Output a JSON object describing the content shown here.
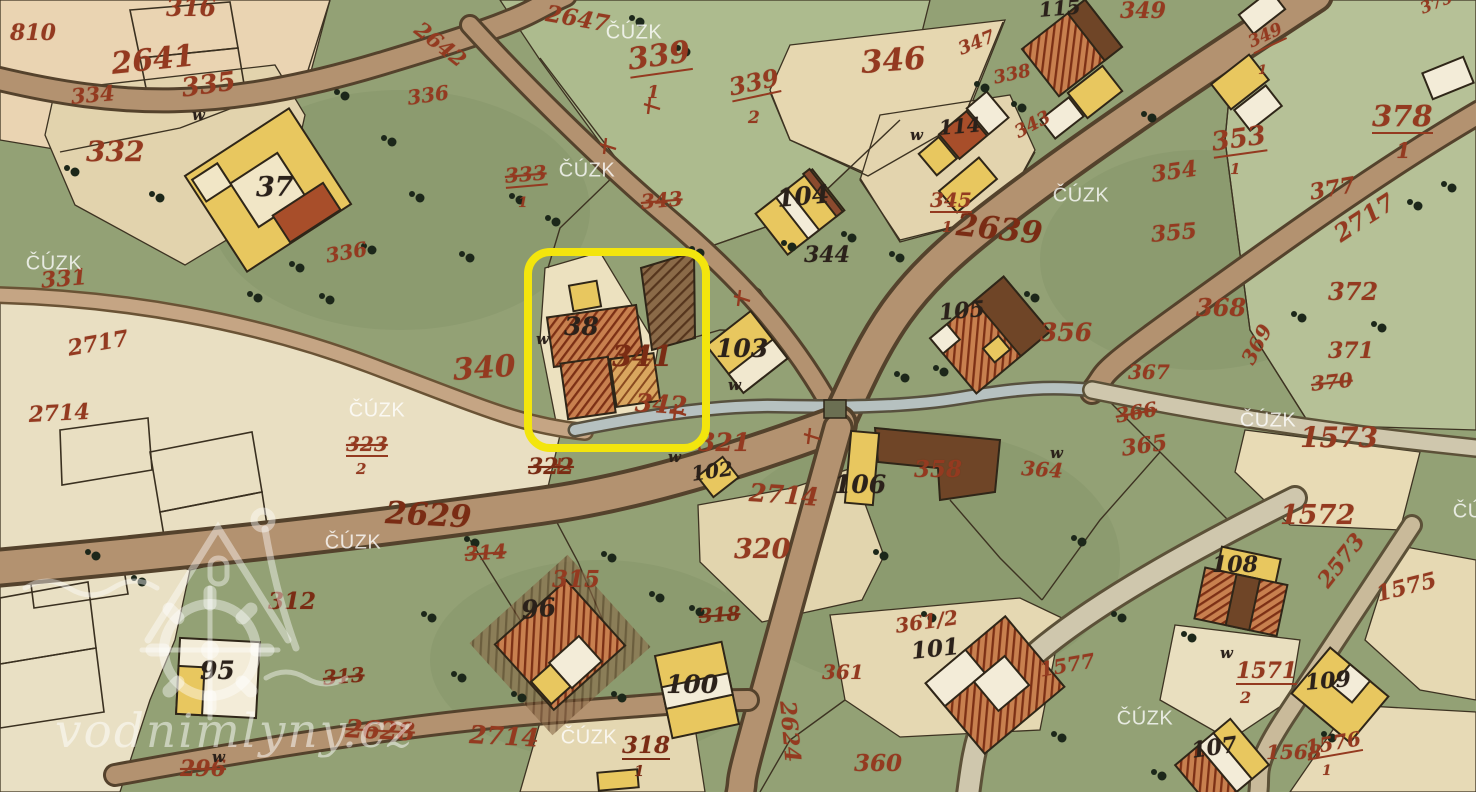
{
  "highlight": {
    "color": "#f3e50d",
    "highlighted_building": "38"
  },
  "watermarks": {
    "cuzk": {
      "text": "ČÚZK",
      "positions": [
        [
          634,
          33
        ],
        [
          587,
          171
        ],
        [
          1081,
          196
        ],
        [
          54,
          264
        ],
        [
          377,
          411
        ],
        [
          1268,
          421
        ],
        [
          353,
          543
        ],
        [
          589,
          738
        ],
        [
          1145,
          719
        ],
        [
          1481,
          512
        ]
      ]
    },
    "site": {
      "text": "vodnimlyny.cz"
    }
  },
  "meadow_marks": {
    "symbol": "w",
    "positions": [
      [
        668,
        450
      ],
      [
        728,
        378
      ],
      [
        910,
        128
      ],
      [
        1220,
        646
      ],
      [
        1050,
        446
      ],
      [
        192,
        108
      ],
      [
        536,
        332
      ],
      [
        212,
        750
      ]
    ]
  },
  "colors": {
    "highlight_yellow": "#f3e50d",
    "parcel_number_red": "#943a20",
    "parcel_number_dark": "#7a2c14",
    "building_number_black": "#2b211a",
    "meadow_green": "#93a175",
    "field_light_green": "#b6c197",
    "field_beige": "#e5d8b4",
    "road_tan": "#b39270",
    "stream_gray": "#b6c1c0",
    "building_yellow": "#e8c75f",
    "building_red": "#c8804f",
    "watermark_white": "rgba(255,255,255,0.78)"
  },
  "map_labels": [
    {
      "t": "810",
      "x": 10,
      "y": 22,
      "s": 22,
      "c": "red"
    },
    {
      "t": "316",
      "x": 166,
      "y": -4,
      "s": 24,
      "c": "red"
    },
    {
      "t": "2641",
      "x": 110,
      "y": 50,
      "s": 30,
      "c": "red",
      "r": -6
    },
    {
      "t": "334",
      "x": 70,
      "y": 86,
      "s": 21,
      "c": "red",
      "r": -5
    },
    {
      "t": "335",
      "x": 180,
      "y": 76,
      "s": 26,
      "c": "red",
      "r": -8
    },
    {
      "t": "332",
      "x": 86,
      "y": 138,
      "s": 28,
      "c": "red"
    },
    {
      "t": "2642",
      "x": 424,
      "y": 18,
      "s": 21,
      "c": "red",
      "r": 38
    },
    {
      "t": "2647",
      "x": 548,
      "y": 2,
      "s": 23,
      "c": "red",
      "r": 10
    },
    {
      "t": "339",
      "x": 626,
      "y": 46,
      "s": 30,
      "c": "red",
      "r": -8,
      "u": 1
    },
    {
      "t": "1",
      "x": 647,
      "y": 84,
      "s": 18,
      "c": "red"
    },
    {
      "t": "339",
      "x": 727,
      "y": 76,
      "s": 24,
      "c": "red",
      "r": -12,
      "u": 1
    },
    {
      "t": "2",
      "x": 748,
      "y": 110,
      "s": 17,
      "c": "red"
    },
    {
      "t": "346",
      "x": 860,
      "y": 48,
      "s": 31,
      "c": "red",
      "r": -4
    },
    {
      "t": "347",
      "x": 956,
      "y": 42,
      "s": 18,
      "c": "red",
      "r": -22
    },
    {
      "t": "338",
      "x": 992,
      "y": 70,
      "s": 18,
      "c": "red",
      "r": -12
    },
    {
      "t": "343",
      "x": 1012,
      "y": 126,
      "s": 18,
      "c": "red",
      "r": -28
    },
    {
      "t": "345",
      "x": 930,
      "y": 190,
      "s": 20,
      "c": "red",
      "u": 1
    },
    {
      "t": "1",
      "x": 942,
      "y": 220,
      "s": 15,
      "c": "red"
    },
    {
      "t": "2639",
      "x": 958,
      "y": 210,
      "s": 31,
      "c": "dark",
      "r": 6
    },
    {
      "t": "349",
      "x": 1120,
      "y": 0,
      "s": 22,
      "c": "red"
    },
    {
      "t": "349",
      "x": 1246,
      "y": 36,
      "s": 17,
      "c": "red",
      "r": -25,
      "u": 1
    },
    {
      "t": "1",
      "x": 1258,
      "y": 64,
      "s": 13,
      "c": "red"
    },
    {
      "t": "375",
      "x": 1418,
      "y": 2,
      "s": 16,
      "c": "red",
      "r": -22
    },
    {
      "t": "378",
      "x": 1372,
      "y": 102,
      "s": 29,
      "c": "red",
      "u": 1
    },
    {
      "t": "1",
      "x": 1396,
      "y": 140,
      "s": 21,
      "c": "red"
    },
    {
      "t": "353",
      "x": 1210,
      "y": 130,
      "s": 26,
      "c": "red",
      "r": -8,
      "u": 1
    },
    {
      "t": "1",
      "x": 1230,
      "y": 162,
      "s": 15,
      "c": "red"
    },
    {
      "t": "354",
      "x": 1150,
      "y": 164,
      "s": 22,
      "c": "red",
      "r": -8
    },
    {
      "t": "377",
      "x": 1308,
      "y": 182,
      "s": 22,
      "c": "red",
      "r": -10
    },
    {
      "t": "355",
      "x": 1150,
      "y": 224,
      "s": 22,
      "c": "red",
      "r": -5
    },
    {
      "t": "2717",
      "x": 1330,
      "y": 226,
      "s": 24,
      "c": "red",
      "r": -33
    },
    {
      "t": "331",
      "x": 40,
      "y": 270,
      "s": 22,
      "c": "red",
      "r": -5
    },
    {
      "t": "336",
      "x": 324,
      "y": 246,
      "s": 20,
      "c": "red",
      "r": -10
    },
    {
      "t": "2717",
      "x": 66,
      "y": 338,
      "s": 22,
      "c": "red",
      "r": -10
    },
    {
      "t": "2714",
      "x": 28,
      "y": 404,
      "s": 22,
      "c": "red",
      "r": -3
    },
    {
      "t": "336",
      "x": 406,
      "y": 88,
      "s": 20,
      "c": "red",
      "r": -8
    },
    {
      "t": "333",
      "x": 504,
      "y": 166,
      "s": 20,
      "c": "red",
      "r": -5,
      "st": 1,
      "u": 1
    },
    {
      "t": "1",
      "x": 518,
      "y": 196,
      "s": 14,
      "c": "red"
    },
    {
      "t": "343",
      "x": 640,
      "y": 192,
      "s": 20,
      "c": "red",
      "r": -5,
      "st": 1
    },
    {
      "t": "340",
      "x": 452,
      "y": 356,
      "s": 30,
      "c": "red",
      "r": -4
    },
    {
      "t": "341",
      "x": 612,
      "y": 342,
      "s": 29,
      "c": "dark"
    },
    {
      "t": "342",
      "x": 636,
      "y": 390,
      "s": 25,
      "c": "red",
      "r": 4
    },
    {
      "t": "323",
      "x": 346,
      "y": 434,
      "s": 20,
      "c": "red",
      "st": 1,
      "u": 1
    },
    {
      "t": "2",
      "x": 356,
      "y": 462,
      "s": 15,
      "c": "red"
    },
    {
      "t": "322",
      "x": 528,
      "y": 456,
      "s": 22,
      "c": "dark",
      "st": 1
    },
    {
      "t": "321",
      "x": 698,
      "y": 430,
      "s": 25,
      "c": "red"
    },
    {
      "t": "2714",
      "x": 750,
      "y": 480,
      "s": 25,
      "c": "red",
      "r": 4
    },
    {
      "t": "320",
      "x": 734,
      "y": 536,
      "s": 27,
      "c": "red"
    },
    {
      "t": "2629",
      "x": 386,
      "y": 498,
      "s": 31,
      "c": "dark",
      "r": 3
    },
    {
      "t": "314",
      "x": 464,
      "y": 544,
      "s": 20,
      "c": "red",
      "st": 1,
      "r": -4
    },
    {
      "t": "315",
      "x": 552,
      "y": 568,
      "s": 23,
      "c": "red"
    },
    {
      "t": "312",
      "x": 268,
      "y": 590,
      "s": 23,
      "c": "dark"
    },
    {
      "t": "313",
      "x": 322,
      "y": 668,
      "s": 20,
      "c": "dark",
      "st": 1,
      "r": -5
    },
    {
      "t": "296",
      "x": 180,
      "y": 758,
      "s": 22,
      "c": "red",
      "st": 1
    },
    {
      "t": "2628",
      "x": 346,
      "y": 716,
      "s": 25,
      "c": "red",
      "st": 1,
      "r": 3
    },
    {
      "t": "2714",
      "x": 470,
      "y": 722,
      "s": 25,
      "c": "red",
      "r": 3
    },
    {
      "t": "318",
      "x": 698,
      "y": 606,
      "s": 20,
      "c": "dark",
      "st": 1,
      "r": -4
    },
    {
      "t": "318",
      "x": 622,
      "y": 734,
      "s": 23,
      "c": "dark",
      "u": 1
    },
    {
      "t": "1",
      "x": 634,
      "y": 764,
      "s": 15,
      "c": "dark"
    },
    {
      "t": "2624",
      "x": 798,
      "y": 700,
      "s": 22,
      "c": "red",
      "r": 85
    },
    {
      "t": "360",
      "x": 854,
      "y": 752,
      "s": 23,
      "c": "red"
    },
    {
      "t": "361",
      "x": 822,
      "y": 662,
      "s": 20,
      "c": "red"
    },
    {
      "t": "361/2",
      "x": 894,
      "y": 616,
      "s": 20,
      "c": "red",
      "r": -8
    },
    {
      "t": "1577",
      "x": 1038,
      "y": 660,
      "s": 20,
      "c": "red",
      "r": -10
    },
    {
      "t": "358",
      "x": 914,
      "y": 458,
      "s": 23,
      "c": "red"
    },
    {
      "t": "356",
      "x": 1040,
      "y": 320,
      "s": 25,
      "c": "red"
    },
    {
      "t": "367",
      "x": 1128,
      "y": 362,
      "s": 20,
      "c": "red"
    },
    {
      "t": "366",
      "x": 1114,
      "y": 406,
      "s": 20,
      "c": "red",
      "r": -10,
      "st": 1
    },
    {
      "t": "365",
      "x": 1120,
      "y": 438,
      "s": 22,
      "c": "red",
      "r": -8
    },
    {
      "t": "364",
      "x": 1022,
      "y": 458,
      "s": 20,
      "c": "red",
      "r": 4
    },
    {
      "t": "368",
      "x": 1196,
      "y": 296,
      "s": 24,
      "c": "red"
    },
    {
      "t": "372",
      "x": 1328,
      "y": 280,
      "s": 24,
      "c": "red"
    },
    {
      "t": "371",
      "x": 1328,
      "y": 340,
      "s": 22,
      "c": "red"
    },
    {
      "t": "369",
      "x": 1238,
      "y": 358,
      "s": 20,
      "c": "red",
      "r": -62
    },
    {
      "t": "370",
      "x": 1310,
      "y": 374,
      "s": 20,
      "c": "red",
      "st": 1,
      "r": -6
    },
    {
      "t": "1573",
      "x": 1300,
      "y": 424,
      "s": 28,
      "c": "red"
    },
    {
      "t": "1572",
      "x": 1280,
      "y": 502,
      "s": 27,
      "c": "red"
    },
    {
      "t": "2573",
      "x": 1314,
      "y": 578,
      "s": 22,
      "c": "red",
      "r": -52
    },
    {
      "t": "1575",
      "x": 1374,
      "y": 584,
      "s": 22,
      "c": "red",
      "r": -14
    },
    {
      "t": "1571",
      "x": 1236,
      "y": 660,
      "s": 22,
      "c": "red",
      "u": 1
    },
    {
      "t": "2",
      "x": 1240,
      "y": 690,
      "s": 16,
      "c": "red"
    },
    {
      "t": "1568",
      "x": 1266,
      "y": 742,
      "s": 20,
      "c": "red"
    },
    {
      "t": "1576",
      "x": 1304,
      "y": 738,
      "s": 20,
      "c": "red",
      "r": -10,
      "u": 1
    },
    {
      "t": "1",
      "x": 1322,
      "y": 764,
      "s": 14,
      "c": "red"
    },
    {
      "t": "37",
      "x": 256,
      "y": 174,
      "s": 27,
      "c": "black"
    },
    {
      "t": "38",
      "x": 564,
      "y": 314,
      "s": 25,
      "c": "black"
    },
    {
      "t": "95",
      "x": 200,
      "y": 658,
      "s": 25,
      "c": "black"
    },
    {
      "t": "96",
      "x": 520,
      "y": 598,
      "s": 25,
      "c": "black",
      "r": -6
    },
    {
      "t": "100",
      "x": 666,
      "y": 672,
      "s": 25,
      "c": "black"
    },
    {
      "t": "101",
      "x": 910,
      "y": 640,
      "s": 23,
      "c": "black",
      "r": -6
    },
    {
      "t": "102",
      "x": 690,
      "y": 464,
      "s": 20,
      "c": "black",
      "r": -8
    },
    {
      "t": "103",
      "x": 716,
      "y": 336,
      "s": 25,
      "c": "black"
    },
    {
      "t": "104",
      "x": 776,
      "y": 186,
      "s": 25,
      "c": "black",
      "r": -5
    },
    {
      "t": "105",
      "x": 938,
      "y": 302,
      "s": 22,
      "c": "black",
      "r": -5
    },
    {
      "t": "106",
      "x": 834,
      "y": 472,
      "s": 25,
      "c": "black"
    },
    {
      "t": "107",
      "x": 1190,
      "y": 740,
      "s": 22,
      "c": "black",
      "r": -8
    },
    {
      "t": "108",
      "x": 1212,
      "y": 554,
      "s": 22,
      "c": "black"
    },
    {
      "t": "109",
      "x": 1304,
      "y": 672,
      "s": 22,
      "c": "black",
      "r": -5
    },
    {
      "t": "114",
      "x": 938,
      "y": 118,
      "s": 20,
      "c": "black",
      "r": -5
    },
    {
      "t": "115",
      "x": 1038,
      "y": 0,
      "s": 20,
      "c": "black",
      "r": -5
    },
    {
      "t": "344",
      "x": 804,
      "y": 244,
      "s": 22,
      "c": "black"
    }
  ]
}
